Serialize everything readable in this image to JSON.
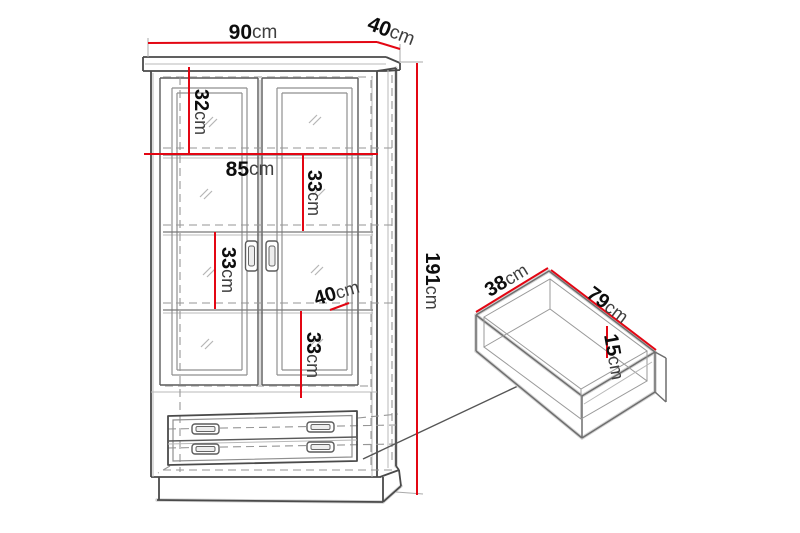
{
  "page": {
    "background": "#ffffff"
  },
  "colors": {
    "dimension_red": "#e30613",
    "line_dark": "#4a4a4a",
    "line_soft": "#9a9a9a",
    "dashed_gray": "#969696"
  },
  "diagram": {
    "subject": "glass-door cabinet with two drawers — technical dimension drawing",
    "cabinet_dimensions": {
      "overall_width": {
        "value": "90",
        "unit": "cm"
      },
      "overall_depth": {
        "value": "40",
        "unit": "cm"
      },
      "overall_height": {
        "value": "191",
        "unit": "cm"
      },
      "top_section_height": {
        "value": "32",
        "unit": "cm"
      },
      "interior_width": {
        "value": "85",
        "unit": "cm"
      },
      "shelf_gap_upper": {
        "value": "33",
        "unit": "cm"
      },
      "shelf_gap_middle": {
        "value": "33",
        "unit": "cm"
      },
      "shelf_depth": {
        "value": "40",
        "unit": "cm"
      },
      "shelf_gap_lower": {
        "value": "33",
        "unit": "cm"
      }
    },
    "drawer_dimensions": {
      "inner_depth": {
        "value": "38",
        "unit": "cm"
      },
      "inner_width": {
        "value": "79",
        "unit": "cm"
      },
      "front_height": {
        "value": "15",
        "unit": "cm"
      }
    }
  }
}
